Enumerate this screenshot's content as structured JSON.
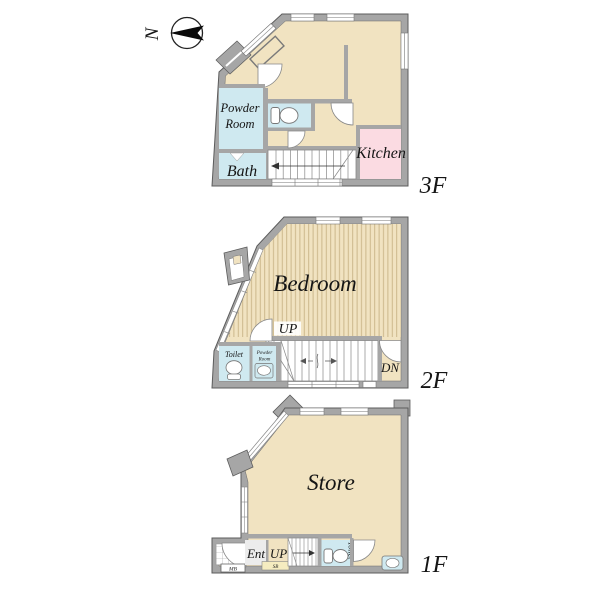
{
  "compass": {
    "north": "N"
  },
  "floor3": {
    "label": "3F",
    "powder_room_line1": "Powder",
    "powder_room_line2": "Room",
    "bath": "Bath",
    "kitchen": "Kitchen"
  },
  "floor2": {
    "label": "2F",
    "bedroom": "Bedroom",
    "up": "UP",
    "down": "DN",
    "toilet": "Toilet",
    "powder_room_line1": "Powder",
    "powder_room_line2": "Room"
  },
  "floor1": {
    "label": "1F",
    "store": "Store",
    "entrance": "Ent",
    "up": "UP",
    "toilet": "Toilet",
    "meter_box": "MB",
    "shoe_box": "SB"
  },
  "colors": {
    "wall": "#a6a6a6",
    "wall_outline": "#5c5c5c",
    "floor_beige": "#f1e3c1",
    "stripe_line": "#c8b386",
    "wet_blue": "#cfe9f0",
    "kitchen_pink": "#fbdbe2",
    "shoe_box_yellow": "#f5ecc0",
    "text": "#151515"
  }
}
